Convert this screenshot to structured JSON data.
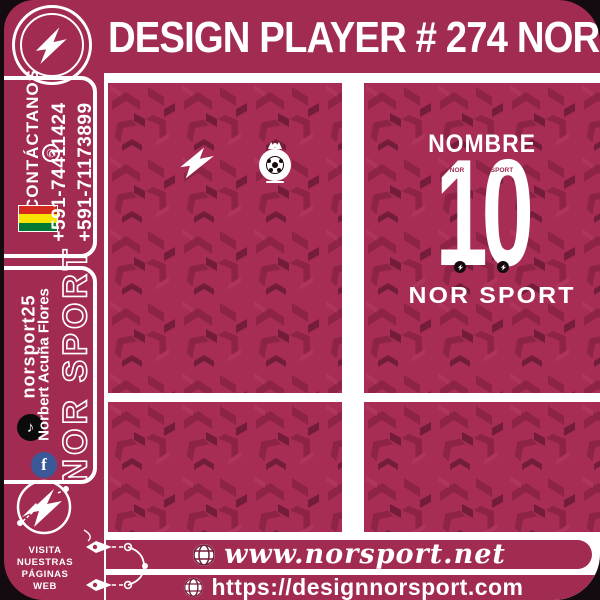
{
  "header": {
    "title": "DESIGN PLAYER # 274 NOR",
    "logo_icon": "nor-sport-lightning-logo"
  },
  "sidebar": {
    "contact": {
      "label": "CONTÁCTANOS",
      "whatsapp_icon": "whatsapp-phone-icon",
      "flag_icon": "bolivia-flag",
      "phones": [
        "+591-74411424",
        "+591-71173899"
      ]
    },
    "social": [
      {
        "network": "tiktok",
        "icon": "tiktok-icon",
        "handle": "norsport25"
      },
      {
        "network": "facebook",
        "icon": "facebook-icon",
        "handle": "Norbert Acuña Flores"
      }
    ],
    "brand_vertical": "NOR SPORT",
    "badge_icon": "nor-sport-pen-lightning-badge",
    "visit": [
      "VISITA",
      "NUESTRAS",
      "PÁGINAS",
      "WEB"
    ]
  },
  "jersey": {
    "front": {
      "brand_icon": "lightning-bolt-logo",
      "crest_icon": "team-soccer-crest"
    },
    "back": {
      "name_label": "NOMBRE",
      "number": "10",
      "number_insert_left": "NOR",
      "number_insert_right": "SPORT",
      "number_dot_icon": "mini-lightning-dot",
      "brand": "NOR SPORT"
    }
  },
  "footer": {
    "globe_icon": "globe-icon",
    "pen_icon": "pen-nib-decoration",
    "links": [
      {
        "url": "www.norsport.net"
      },
      {
        "url": "https://designnorsport.com"
      }
    ]
  },
  "colors": {
    "maroon": "#a22b51",
    "pattern_base": "#a72d54",
    "pattern_mid": "#8d2446",
    "pattern_dark": "#731d3a",
    "pattern_light": "#b43a62",
    "black_edge": "#140b10",
    "tiktok_black": "#0b0b0b",
    "facebook_blue": "#3b5998",
    "flag_red": "#d52b1e",
    "flag_yellow": "#f9e300",
    "flag_green": "#007934",
    "white": "#ffffff"
  }
}
